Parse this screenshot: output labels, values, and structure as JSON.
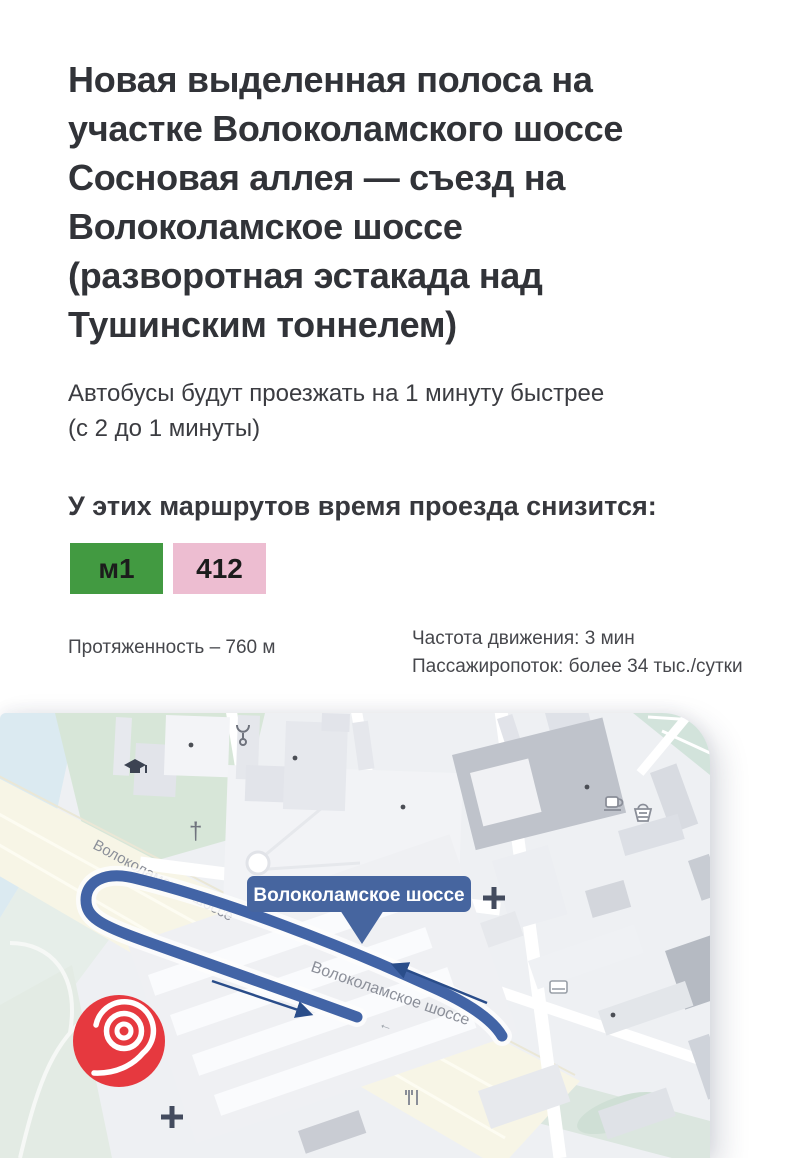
{
  "page": {
    "background": "#ffffff"
  },
  "title": {
    "lines": [
      "Новая выделенная полоса на",
      "участке Волоколамского шоссе",
      "Сосновая аллея — съезд на",
      "Волоколамское шоссе",
      "(разворотная эстакада над",
      "Тушинским тоннелем)"
    ]
  },
  "subtitle": {
    "lines": [
      "Автобусы будут проезжать на 1 минуту быстрее",
      "(с 2 до 1 минуты)"
    ]
  },
  "routes_section": {
    "heading": "У этих маршрутов время проезда снизится:",
    "badges": [
      {
        "label": "м1",
        "background": "#429a41"
      },
      {
        "label": "412",
        "background": "#edbdd1"
      }
    ]
  },
  "stats": {
    "length": "Протяженность – 760 м",
    "frequency": "Частота движения: 3 мин",
    "passenger_flow": "Пассажиропоток: более 34 тыс./сутки"
  },
  "map": {
    "badge_label": "Волоколамское шоссе",
    "street_name_top": "Волоколамское шоссе",
    "street_name_center": "Волоколамское шоссе",
    "one_way_arrow": "←",
    "church_cross": "†",
    "colors": {
      "route_blue": "#4264a6",
      "badge_blue": "#46659f",
      "arrow_navy": "#2a4d8a",
      "logo_red": "#e6393f",
      "map_background": "#eef0f3",
      "water": "#dbeaf1",
      "park": "#d7e6d8",
      "median_green": "#dbe6df",
      "highway": "#f7f5e6",
      "street_text": "#8b8f99"
    }
  }
}
